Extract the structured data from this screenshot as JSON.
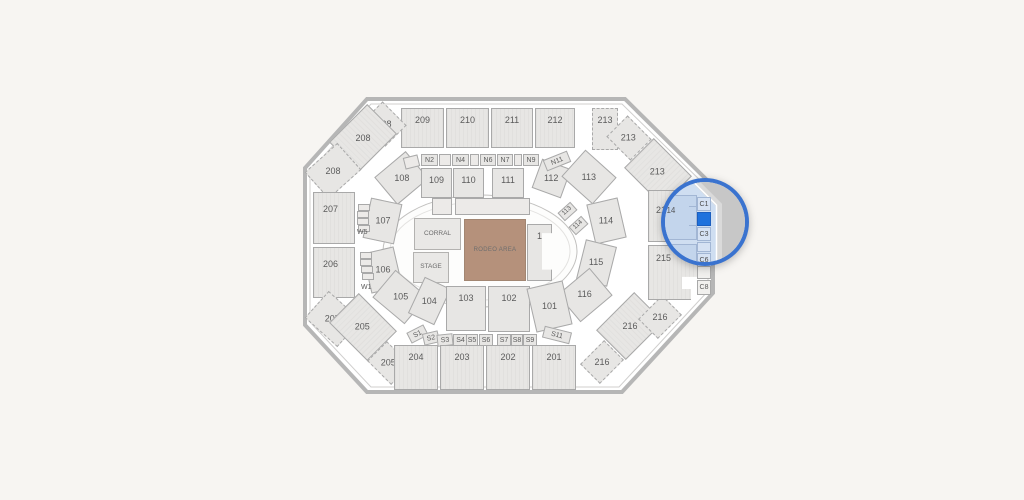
{
  "venue_map": {
    "floor": {
      "corral": "CORRAL",
      "stage": "STAGE",
      "rodeo_area": "RODEO AREA",
      "section1": "1"
    },
    "sections_outer": {
      "201": "201",
      "202": "202",
      "203": "203",
      "204": "204",
      "205": "205",
      "206": "206",
      "207": "207",
      "208": "208",
      "209": "209",
      "210": "210",
      "211": "211",
      "212": "212",
      "213": "213",
      "214": "214",
      "215": "215",
      "216": "216"
    },
    "sections_inner": {
      "101": "101",
      "102": "102",
      "103": "103",
      "104": "104",
      "105": "105",
      "106": "106",
      "107": "107",
      "108": "108",
      "109": "109",
      "110": "110",
      "111": "111",
      "112": "112",
      "113": "113",
      "114": "114",
      "115": "115",
      "116": "116"
    },
    "boxes_north": {
      "N2": "N2",
      "N4": "N4",
      "N6": "N6",
      "N7": "N7",
      "N9": "N9",
      "N11": "N11"
    },
    "boxes_south": {
      "S1": "S1",
      "S2": "S2",
      "S3": "S3",
      "S4": "S4",
      "S5": "S5",
      "S6": "S6",
      "S7": "S7",
      "S8": "S8",
      "S9": "S9",
      "S11": "S11"
    },
    "boxes_west": {
      "W1": "W1",
      "W5": "W5"
    },
    "chute_boxes": {
      "C1": "C1",
      "C3": "C3",
      "C6": "C6",
      "C8": "C8"
    },
    "colors": {
      "background": "#f7f5f2",
      "section_fill": "#e7e6e4",
      "section_border": "#a9a9a9",
      "rodeo_floor_fill": "#b5917b",
      "magnifier_ring": "#3a73cf",
      "magnifier_tint": "#cfdef1",
      "selected_section_fill": "#1f72dd"
    }
  }
}
